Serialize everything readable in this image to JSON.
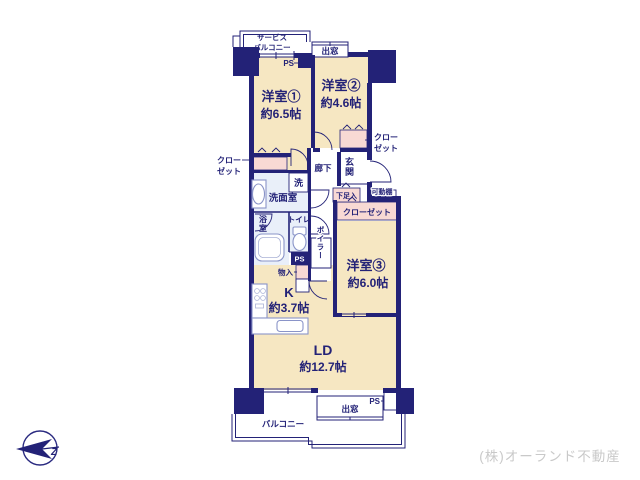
{
  "meta": {
    "credit": "(株)オーランド不動産",
    "compass_letter": "Z"
  },
  "colors": {
    "wall_navy": "#232277",
    "room_floor": "#f6e7c2",
    "closet_pink": "#f8d9d4",
    "wet_area": "#e9eff9",
    "fixture_stroke": "#8a94c8",
    "credit_text": "#c9c9c9",
    "background": "#ffffff"
  },
  "rooms": {
    "youshitsu1": {
      "name": "洋室①",
      "size": "約6.5帖"
    },
    "youshitsu2": {
      "name": "洋室②",
      "size": "約4.6帖"
    },
    "youshitsu3": {
      "name": "洋室③",
      "size": "約6.0帖"
    },
    "ld": {
      "name": "LD",
      "size": "約12.7帖"
    },
    "kitchen": {
      "name": "K",
      "size": "約3.7帖"
    }
  },
  "labels": {
    "service_balcony_1": "サービス",
    "service_balcony_2": "バルコニー",
    "demado_top": "出窓",
    "demado_bottom": "出窓",
    "ps_top": "PS",
    "ps_mid": "PS",
    "ps_bottom": "PS",
    "closet1_line1": "クロー",
    "closet1_line2": "ゼット",
    "closet2_line1": "クロー",
    "closet2_line2": "ゼット",
    "closet3": "クローゼット",
    "rouka": "廊下",
    "genkan": "玄関",
    "getabako": "下足入",
    "kadoudana": "可動棚",
    "sen": "洗",
    "senmenshitsu": "洗面室",
    "yokushitsu": "浴室",
    "toilet": "トイレ",
    "boiler": "ボイラー",
    "monoire": "物入",
    "balcony": "バルコニー"
  }
}
